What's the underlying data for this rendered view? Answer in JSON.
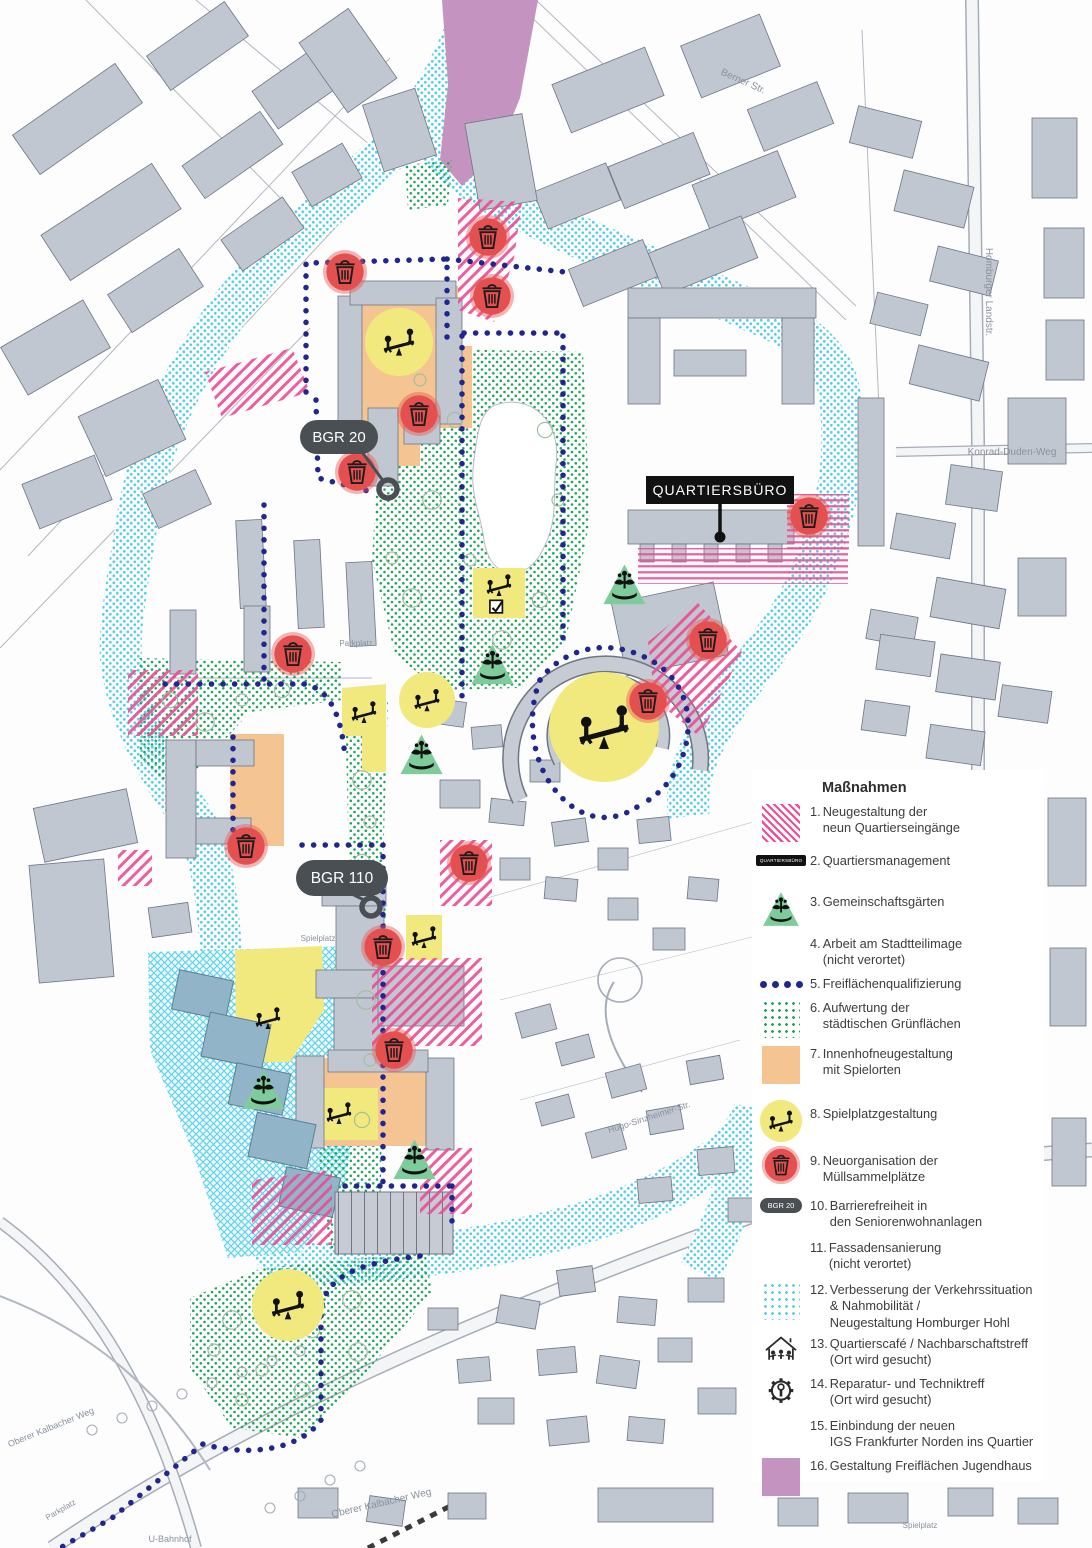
{
  "legend": {
    "title": "Maßnahmen",
    "items": [
      {
        "num": "1.",
        "text": "Neugestaltung der\nneun Quartierseingänge",
        "swatch": "pink"
      },
      {
        "num": "2.",
        "text": "Quartiersmanagement",
        "swatch": "qb-pill",
        "swatch_label": "QUARTIERSBÜRO"
      },
      {
        "num": "3.",
        "text": "Gemeinschaftsgärten",
        "swatch": "garden"
      },
      {
        "num": "4.",
        "text": "Arbeit am Stadtteilimage\n(nicht verortet)",
        "swatch": "none"
      },
      {
        "num": "5.",
        "text": "Freiflächenqualifizierung",
        "swatch": "dots-line"
      },
      {
        "num": "6.",
        "text": "Aufwertung der\nstädtischen Grünflächen",
        "swatch": "green-dots"
      },
      {
        "num": "7.",
        "text": "Innenhofneugestaltung\nmit Spielorten",
        "swatch": "orange"
      },
      {
        "num": "8.",
        "text": "Spielplatzgestaltung",
        "swatch": "play-circle"
      },
      {
        "num": "9.",
        "text": "Neuorganisation der\nMüllsammelplätze",
        "swatch": "trash"
      },
      {
        "num": "10.",
        "text": "Barrierefreiheit in\nden Seniorenwohnanlagen",
        "swatch": "bgr-pill",
        "swatch_label": "BGR 20"
      },
      {
        "num": "11.",
        "text": "Fassadensanierung\n(nicht verortet)",
        "swatch": "none"
      },
      {
        "num": "12.",
        "text": "Verbesserung der Verkehrssituation\n& Nahmobilität /\nNeugestaltung Homburger Hohl",
        "swatch": "cyan-dots"
      },
      {
        "num": "13.",
        "text": "Quartierscafé / Nachbarschaftstreff\n(Ort wird gesucht)",
        "swatch": "house"
      },
      {
        "num": "14.",
        "text": "Reparatur- und Techniktreff\n(Ort wird gesucht)",
        "swatch": "gear"
      },
      {
        "num": "15.",
        "text": "Einbindung der neuen\nIGS Frankfurter Norden ins Quartier",
        "swatch": "cyan-cross"
      },
      {
        "num": "16.",
        "text": "Gestaltung Freiflächen Jugendhaus",
        "swatch": "purple"
      }
    ]
  },
  "map": {
    "callouts": {
      "bgr20": "BGR 20",
      "bgr110": "BGR 110",
      "quartiersbuero": "QUARTIERSBÜRO"
    },
    "street_labels": [
      {
        "text": "Berner Str.",
        "x": 742,
        "y": 84,
        "rot": 24,
        "size": 10
      },
      {
        "text": "Homburger Landstr.",
        "x": 986,
        "y": 292,
        "rot": 90,
        "size": 10
      },
      {
        "text": "Konrad-Duden-Weg",
        "x": 1012,
        "y": 455,
        "rot": 0,
        "size": 10
      },
      {
        "text": "Parkplatz",
        "x": 356,
        "y": 646,
        "rot": 0,
        "size": 8
      },
      {
        "text": "Spielplatz",
        "x": 318,
        "y": 941,
        "rot": 0,
        "size": 8
      },
      {
        "text": "Hugo-Sinzheimer-Str.",
        "x": 650,
        "y": 1120,
        "rot": -18,
        "size": 9
      },
      {
        "text": "Oberer Kalbacher Weg",
        "x": 382,
        "y": 1506,
        "rot": -13,
        "size": 10
      },
      {
        "text": "Oberer Kalbacher Weg",
        "x": 52,
        "y": 1430,
        "rot": -22,
        "size": 9
      },
      {
        "text": "Parkplatz",
        "x": 62,
        "y": 1512,
        "rot": -30,
        "size": 8
      },
      {
        "text": "U-Bahnhof",
        "x": 170,
        "y": 1542,
        "rot": 0,
        "size": 9
      },
      {
        "text": "Spielplatz",
        "x": 920,
        "y": 1528,
        "rot": 0,
        "size": 8
      }
    ],
    "markers": {
      "trash": [
        [
          345,
          272
        ],
        [
          488,
          237
        ],
        [
          492,
          296
        ],
        [
          419,
          414
        ],
        [
          357,
          472
        ],
        [
          293,
          654
        ],
        [
          809,
          516
        ],
        [
          708,
          640
        ],
        [
          648,
          701
        ],
        [
          246,
          846
        ],
        [
          469,
          863
        ],
        [
          383,
          947
        ],
        [
          394,
          1050
        ]
      ],
      "community_gardens": [
        [
          624,
          588
        ],
        [
          492,
          668
        ],
        [
          421,
          758
        ],
        [
          263,
          1093
        ],
        [
          414,
          1163
        ]
      ],
      "playground_circles": [
        [
          399,
          342,
          34
        ],
        [
          427,
          700,
          28
        ],
        [
          604,
          727,
          55
        ],
        [
          288,
          1305,
          36
        ]
      ],
      "play_icons": [
        [
          364,
          712
        ],
        [
          268,
          1018
        ],
        [
          424,
          937
        ],
        [
          339,
          1113
        ],
        [
          499,
          585
        ]
      ],
      "checkboxes": [
        [
          497,
          607
        ]
      ]
    }
  }
}
